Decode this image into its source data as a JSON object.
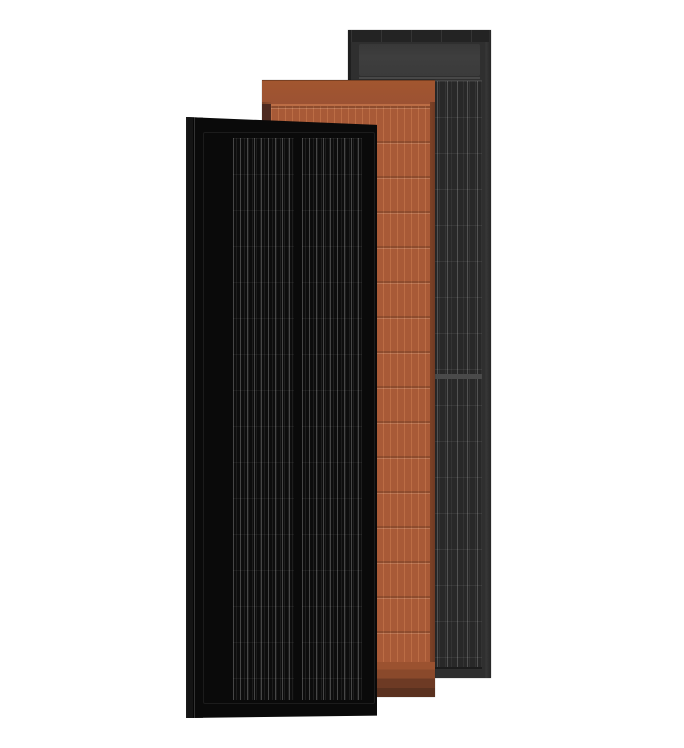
{
  "scene": {
    "kind": "product-render",
    "subject": "Three overlapping framed solar roof panels standing upright on a white background",
    "panels": [
      {
        "name": "black-solar-panel",
        "position": "front-left",
        "color_name": "matte black",
        "features": [
          "full black frame",
          "left mounting flange",
          "two columns of fine vertical busbar lines",
          "horizontal cell rows"
        ]
      },
      {
        "name": "terracotta-solar-panel",
        "position": "middle",
        "color_name": "terracotta orange",
        "features": [
          "solid header band",
          "grid of vertical cell lines with horizontal row grooves",
          "stepped darker footer bands",
          "rounded lower cell corners"
        ]
      },
      {
        "name": "slate-gray-solar-panel",
        "position": "back-right",
        "color_name": "slate gray",
        "features": [
          "top cap strip with segment ticks",
          "lighter gray header band",
          "columned cell grid with bright separators",
          "thick mid seam"
        ]
      }
    ],
    "colors": {
      "bg": "#ffffff",
      "black-face": "#0d0d0d",
      "black-frame": "#0a0a0a",
      "black-flange": "#141414",
      "black-line": "#464646",
      "terra-face": "#a85a37",
      "terra-header": "#9c5233",
      "terra-line": "#bc6d45",
      "terra-frame": "#7c4227",
      "terra-shadow": "#4e2a20",
      "terra-foot1": "#9b5230",
      "terra-foot2": "#8a492b",
      "terra-foot3": "#6d3a24",
      "terra-foot4": "#5a311f",
      "gray-face": "#282828",
      "gray-frame": "#2f2f2f",
      "gray-cap": "#232323",
      "gray-header": "#3e3e3e",
      "gray-line": "#525252",
      "gray-seam": "#4a4a4a"
    }
  }
}
